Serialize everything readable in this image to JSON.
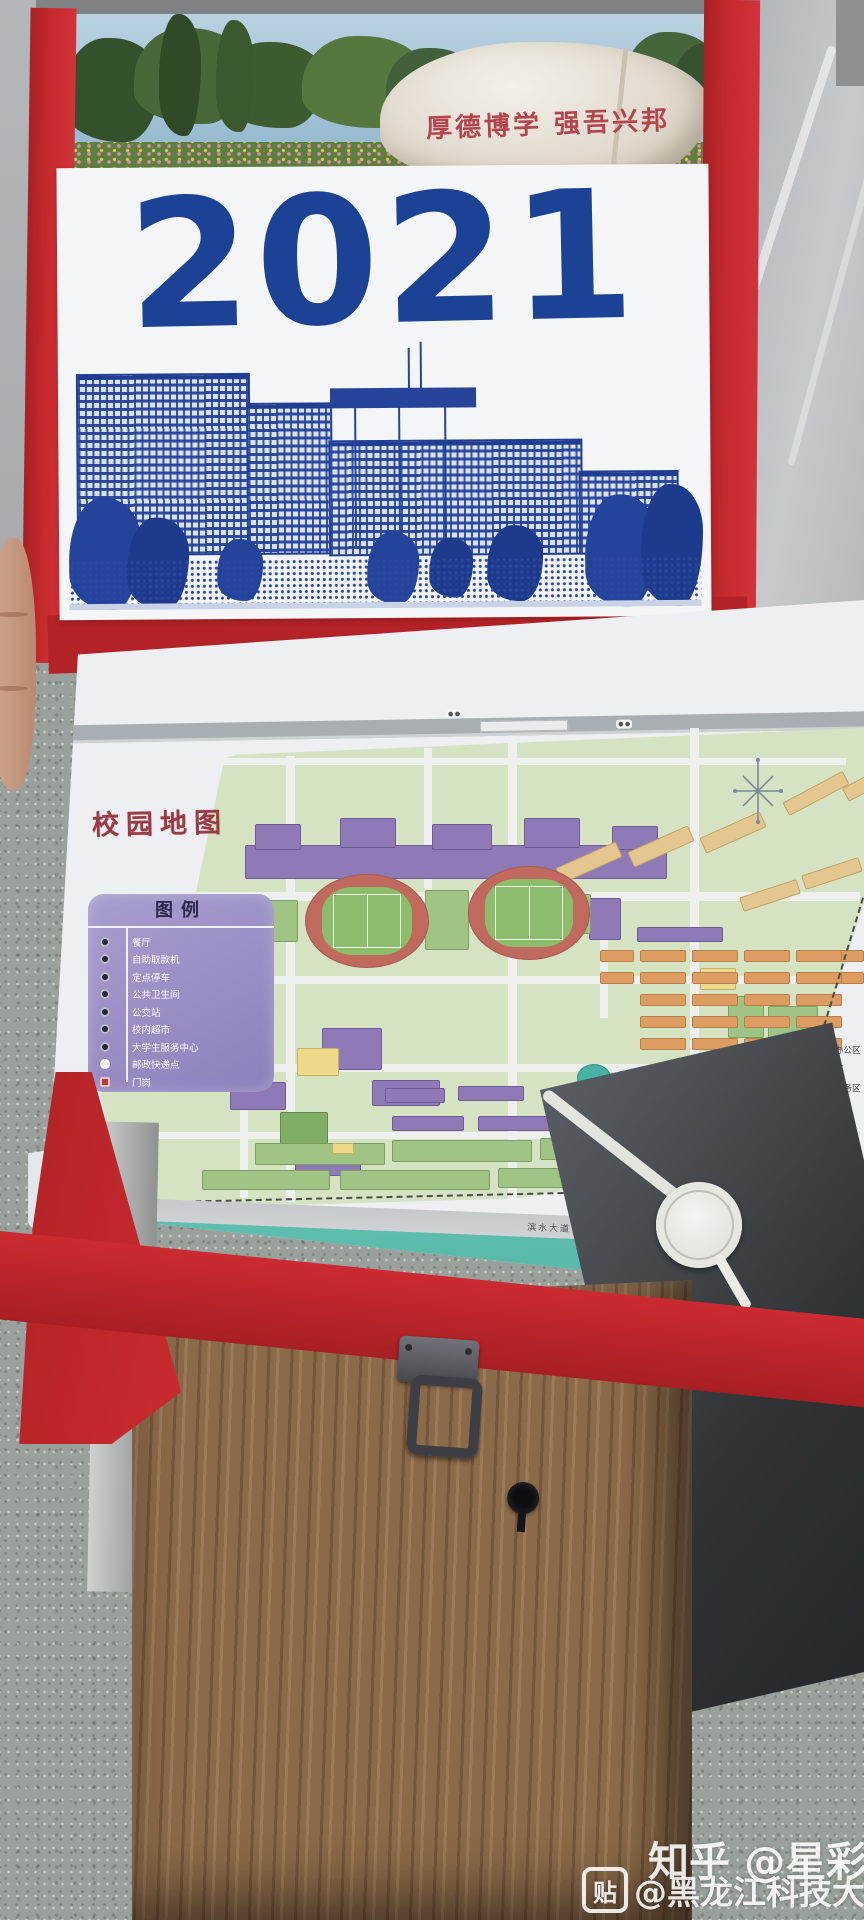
{
  "calendar": {
    "year": "2021",
    "motto": "厚德博学 强吾兴邦"
  },
  "map_page": {
    "title": "校园地图",
    "legend_box": {
      "title": "图例",
      "items": [
        "餐厅",
        "自助取款机",
        "定点停车",
        "公共卫生间",
        "公交站",
        "校内超市",
        "大学生服务中心",
        "邮政快递点",
        "门岗"
      ]
    },
    "area_legend": [
      {
        "label": "教学科研办公区",
        "color": "#8d7ab6"
      },
      {
        "label": "休闲娱乐区",
        "color": "#58b9a9"
      },
      {
        "label": "学生生活服务区",
        "color": "#e6d9a8"
      },
      {
        "label": "家属区",
        "color": "#d08a7a"
      },
      {
        "label": "绿地",
        "color": "#9fc484"
      },
      {
        "label": "校园内部道路",
        "color": "#f7f8f7"
      },
      {
        "label": "在建建筑",
        "color": "#ffffff"
      },
      {
        "label": "停车场",
        "color": "#ffffff"
      }
    ],
    "bottom_road": "滨水大道",
    "river": "松 花 江",
    "credit": "矿业工程学院测绘工"
  },
  "watermarks": {
    "tieba_badge": "贴",
    "tieba": "@黑龙江科技大学吧",
    "zhihu": "知乎 @星彩"
  },
  "colors": {
    "cover_red": "#c0282c",
    "year_blue": "#1c4296",
    "river_teal": "#58b9a9"
  }
}
